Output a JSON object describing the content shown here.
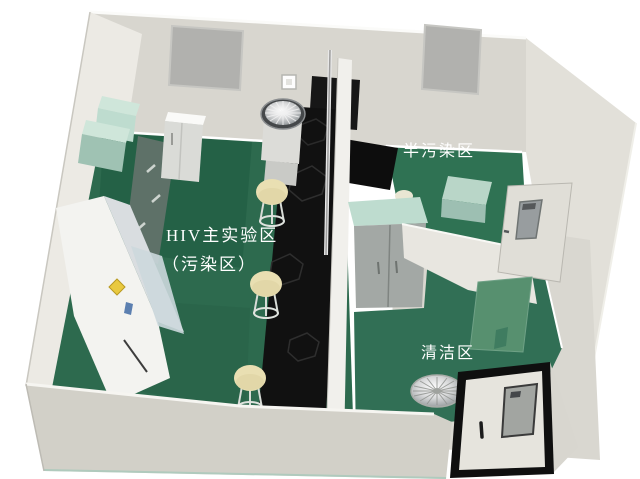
{
  "scene": {
    "title": "HIV实验室三维布局图",
    "zones": {
      "main_line1": "HIV主实验区",
      "main_line2": "（污染区）",
      "semi": "半污染区",
      "clean": "清洁区"
    },
    "objects": [
      "back-wall-window",
      "wall-cabinets",
      "tool-rack",
      "refrigerator",
      "centrifuge",
      "light-switch",
      "biosafety-cabinet",
      "center-lab-bench",
      "lab-stools",
      "partition-wall",
      "wardrobe-cabinet",
      "pass-table",
      "inner-door-with-window",
      "clean-area-door-panel",
      "exhaust-fan",
      "entrance-door"
    ],
    "colors": {
      "floor_main": "#2d6a4e",
      "floor_dark": "#1e593f",
      "floor_semi": "#2f7253",
      "floor_clean": "#316f55",
      "bench_black": "#111111",
      "wall_back": "#d8d6cf",
      "wall_left": "#eceae4",
      "wall_right": "#e2e0d9",
      "wall_front": "#d2d0c8",
      "window_gray": "#b1b1ae",
      "stool_cream": "#e9dfb2",
      "cabinet_mint": "#bedccf",
      "wardrobe_gray": "#a3a8a5",
      "warning_yellow": "#e9c93f",
      "label_blue": "#5b7fb0",
      "door_panel_green": "#57906f",
      "text_white": "#ffffff"
    }
  }
}
